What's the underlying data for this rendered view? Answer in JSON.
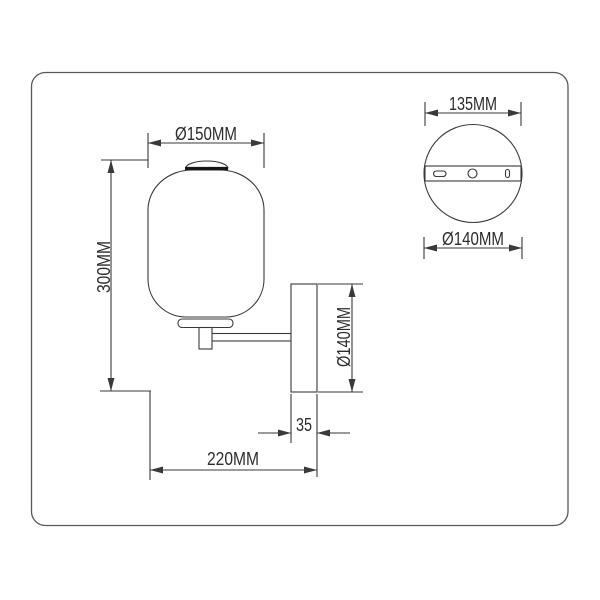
{
  "colors": {
    "background": "#ffffff",
    "line_ink": "#3a3a3a",
    "text_ink": "#2c2c2c",
    "frame_border": "#585858",
    "shade_cap_bar": "#181818"
  },
  "side_view": {
    "dimensions": {
      "shade_diameter": "Ø150MM",
      "overall_height": "300MM",
      "backplate_height": "Ø140MM",
      "backplate_depth": "35",
      "overall_projection": "220MM"
    }
  },
  "backplate_view": {
    "dimensions": {
      "bracket_width": "135MM",
      "plate_diameter": "Ø140MM"
    }
  }
}
